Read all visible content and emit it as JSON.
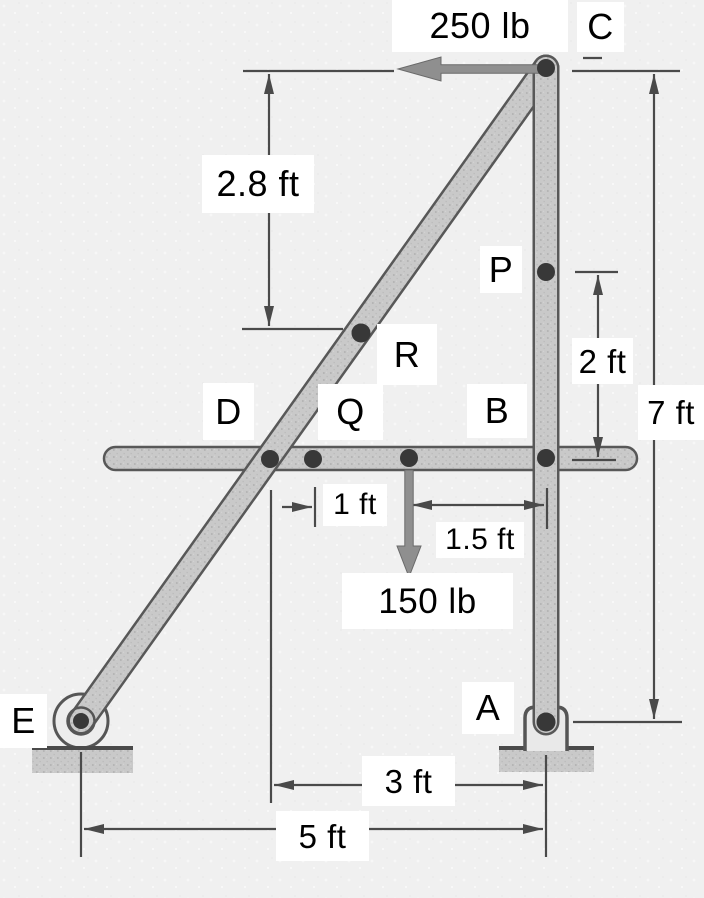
{
  "forces": {
    "applied_top": "250 lb",
    "applied_beam": "150 lb"
  },
  "points": {
    "a": "A",
    "b": "B",
    "c": "C",
    "d": "D",
    "e": "E",
    "p": "P",
    "q": "Q",
    "r": "R"
  },
  "dimensions": {
    "c_to_r": "2.8 ft",
    "p_to_b": "2 ft",
    "c_to_a": "7 ft",
    "q_to_load": "1 ft",
    "load_to_b": "1.5 ft",
    "d_to_a": "3 ft",
    "e_to_a": "5 ft"
  },
  "colors": {
    "background": "#f0f0f0",
    "member_fill": "#c9c9c9",
    "member_outline": "#585858",
    "joint_dot": "#383838",
    "dimension_line": "#4a4a4a",
    "force_arrow": "#8f8f8f",
    "label_background": "#ffffff",
    "label_text": "#000000"
  }
}
